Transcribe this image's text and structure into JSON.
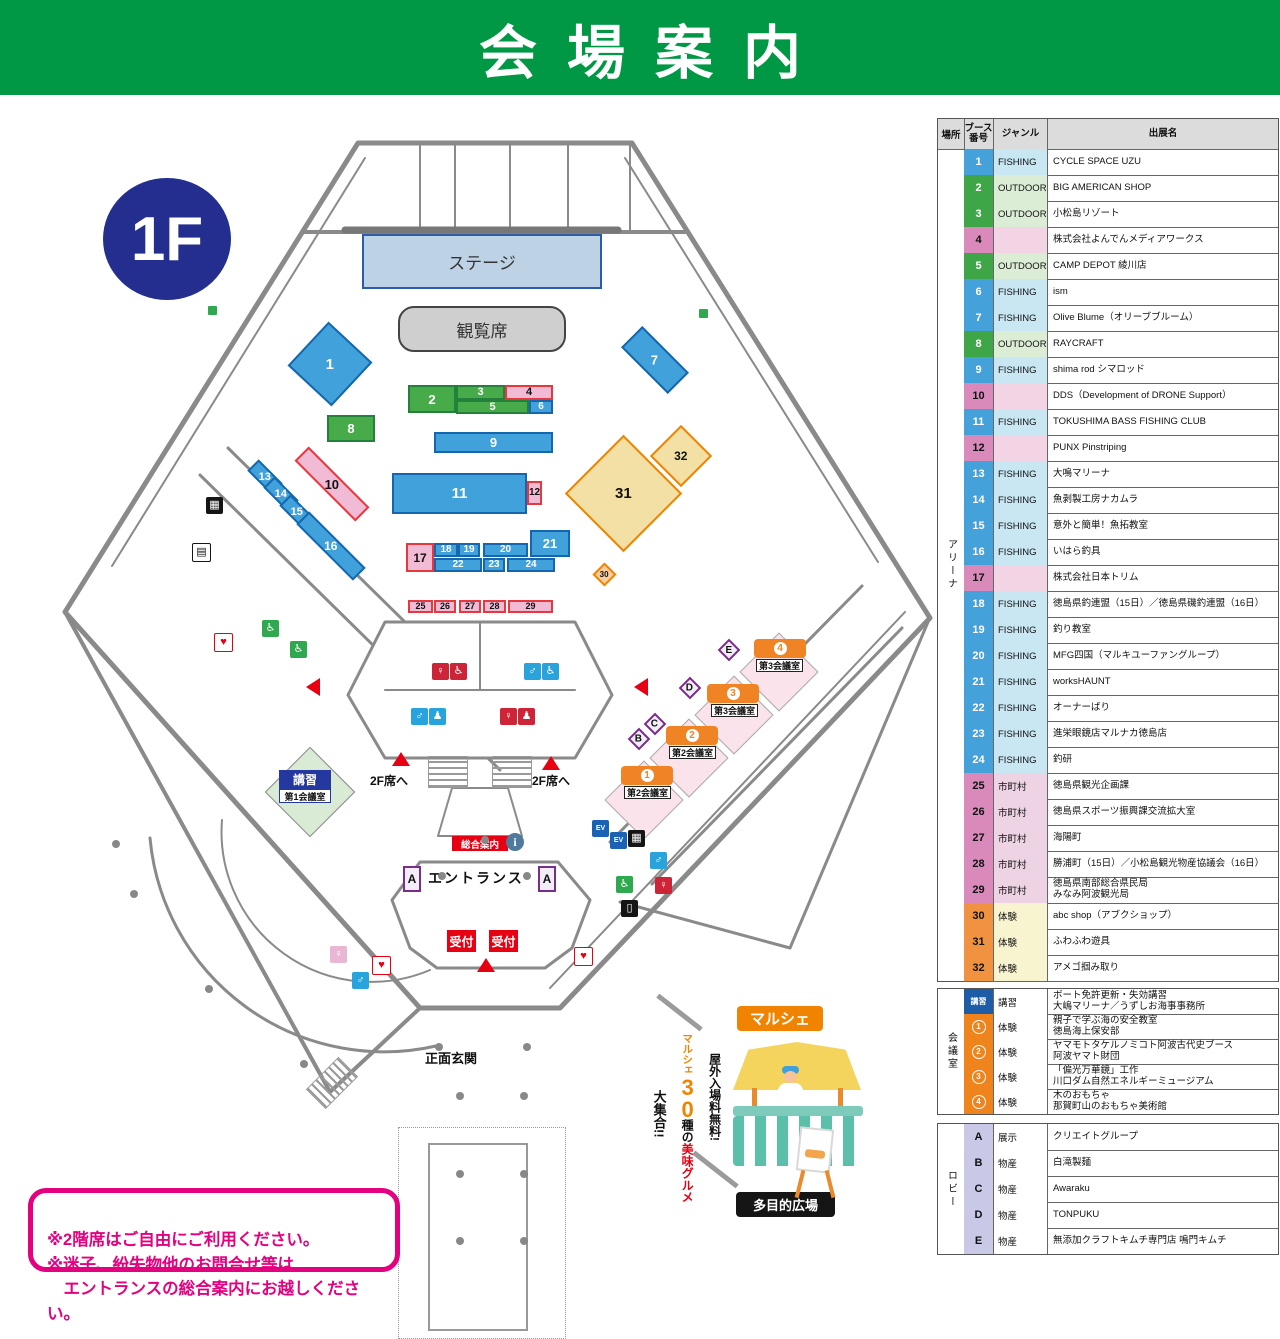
{
  "title": "会場案内",
  "floor_badge": "1F",
  "map": {
    "stage": "ステージ",
    "audience": "観覧席",
    "entrance": "エントランス",
    "main_gate": "正面玄関",
    "to_2f": "2F席へ",
    "info": "総合案内",
    "info_icon": "i",
    "reception": "受付",
    "marche": "マルシェ",
    "multi_plaza": "多目的広場",
    "kosyu_badge": "講習",
    "meeting1": "第1会議室",
    "badge_a": "A",
    "lobby_badges": [
      "B",
      "C",
      "D",
      "E"
    ],
    "meeting_rooms": [
      {
        "num": "1",
        "label": "第2会議室",
        "bx": 621,
        "by": 671,
        "lx": 624,
        "ly": 691
      },
      {
        "num": "2",
        "label": "第2会議室",
        "bx": 666,
        "by": 631,
        "lx": 669,
        "ly": 651
      },
      {
        "num": "3",
        "label": "第3会議室",
        "bx": 707,
        "by": 589,
        "lx": 711,
        "ly": 609
      },
      {
        "num": "4",
        "label": "第3会議室",
        "bx": 754,
        "by": 544,
        "lx": 756,
        "ly": 564
      }
    ],
    "booths": [
      {
        "n": "1",
        "cls": "b-fishing",
        "x": 300,
        "y": 239,
        "w": 60,
        "h": 60,
        "r": 43,
        "fs": 15
      },
      {
        "n": "2",
        "cls": "b-outdoor",
        "x": 408,
        "y": 290,
        "w": 48,
        "h": 28,
        "r": 0,
        "fs": 13
      },
      {
        "n": "3",
        "cls": "b-outdoor",
        "x": 456,
        "y": 290,
        "w": 49,
        "h": 15,
        "r": 0,
        "fs": 11
      },
      {
        "n": "4",
        "cls": "b-pink",
        "x": 505,
        "y": 290,
        "w": 48,
        "h": 15,
        "r": 0,
        "fs": 11
      },
      {
        "n": "5",
        "cls": "b-outdoor",
        "x": 456,
        "y": 305,
        "w": 73,
        "h": 14,
        "r": 0,
        "fs": 11
      },
      {
        "n": "6",
        "cls": "b-fishing",
        "x": 529,
        "y": 305,
        "w": 24,
        "h": 14,
        "r": 0,
        "fs": 10
      },
      {
        "n": "7",
        "cls": "b-fishing",
        "x": 622,
        "y": 250,
        "w": 66,
        "h": 30,
        "r": 45,
        "fs": 13
      },
      {
        "n": "8",
        "cls": "b-outdoor",
        "x": 327,
        "y": 320,
        "w": 48,
        "h": 27,
        "r": 0,
        "fs": 13
      },
      {
        "n": "9",
        "cls": "b-fishing",
        "x": 434,
        "y": 337,
        "w": 119,
        "h": 21,
        "r": 0,
        "fs": 13
      },
      {
        "n": "10",
        "cls": "b-pink",
        "x": 289,
        "y": 379,
        "w": 86,
        "h": 20,
        "r": 45,
        "fs": 13
      },
      {
        "n": "11",
        "cls": "b-fishing",
        "x": 392,
        "y": 378,
        "w": 135,
        "h": 41,
        "r": 0,
        "fs": 15
      },
      {
        "n": "12",
        "cls": "b-pink",
        "x": 527,
        "y": 386,
        "w": 15,
        "h": 24,
        "r": 0,
        "fs": 10
      },
      {
        "n": "13",
        "cls": "b-fishing",
        "x": 248,
        "y": 374,
        "w": 34,
        "h": 16,
        "r": 45,
        "fs": 11
      },
      {
        "n": "14",
        "cls": "b-fishing",
        "x": 264,
        "y": 391,
        "w": 34,
        "h": 16,
        "r": 45,
        "fs": 11
      },
      {
        "n": "15",
        "cls": "b-fishing",
        "x": 280,
        "y": 409,
        "w": 34,
        "h": 16,
        "r": 45,
        "fs": 11
      },
      {
        "n": "16",
        "cls": "b-fishing",
        "x": 291,
        "y": 442,
        "w": 80,
        "h": 18,
        "r": 45,
        "fs": 12
      },
      {
        "n": "17",
        "cls": "b-pink",
        "x": 406,
        "y": 448,
        "w": 28,
        "h": 29,
        "r": 0,
        "fs": 12
      },
      {
        "n": "18",
        "cls": "b-fishing",
        "x": 434,
        "y": 448,
        "w": 24,
        "h": 14,
        "r": 0,
        "fs": 10
      },
      {
        "n": "19",
        "cls": "b-fishing",
        "x": 458,
        "y": 448,
        "w": 22,
        "h": 14,
        "r": 0,
        "fs": 10
      },
      {
        "n": "20",
        "cls": "b-fishing",
        "x": 483,
        "y": 448,
        "w": 45,
        "h": 14,
        "r": 0,
        "fs": 10
      },
      {
        "n": "21",
        "cls": "b-fishing",
        "x": 530,
        "y": 435,
        "w": 40,
        "h": 27,
        "r": 0,
        "fs": 13
      },
      {
        "n": "22",
        "cls": "b-fishing",
        "x": 434,
        "y": 463,
        "w": 48,
        "h": 14,
        "r": 0,
        "fs": 10
      },
      {
        "n": "23",
        "cls": "b-fishing",
        "x": 483,
        "y": 463,
        "w": 22,
        "h": 14,
        "r": 0,
        "fs": 10
      },
      {
        "n": "24",
        "cls": "b-fishing",
        "x": 507,
        "y": 463,
        "w": 48,
        "h": 14,
        "r": 0,
        "fs": 10
      },
      {
        "n": "25",
        "cls": "b-pink",
        "x": 408,
        "y": 505,
        "w": 25,
        "h": 13,
        "r": 0,
        "fs": 9
      },
      {
        "n": "26",
        "cls": "b-pink",
        "x": 434,
        "y": 505,
        "w": 22,
        "h": 13,
        "r": 0,
        "fs": 9
      },
      {
        "n": "27",
        "cls": "b-pink",
        "x": 459,
        "y": 505,
        "w": 22,
        "h": 13,
        "r": 0,
        "fs": 9
      },
      {
        "n": "28",
        "cls": "b-pink",
        "x": 483,
        "y": 505,
        "w": 23,
        "h": 13,
        "r": 0,
        "fs": 9
      },
      {
        "n": "29",
        "cls": "b-pink",
        "x": 508,
        "y": 505,
        "w": 45,
        "h": 13,
        "r": 0,
        "fs": 9
      },
      {
        "n": "30",
        "cls": "b-orangesm",
        "x": 596,
        "y": 471,
        "w": 17,
        "h": 17,
        "r": 45,
        "fs": 8
      },
      {
        "n": "31",
        "cls": "b-yellow",
        "x": 582,
        "y": 357,
        "w": 83,
        "h": 83,
        "r": 45,
        "fs": 15
      },
      {
        "n": "32",
        "cls": "b-yellow",
        "x": 659,
        "y": 339,
        "w": 44,
        "h": 44,
        "r": 45,
        "fs": 12
      }
    ],
    "icons": [
      {
        "name": "womens-toilet-icon",
        "x": 432,
        "y": 568,
        "bg": "#CE2438",
        "fg": "#fff",
        "glyph": "♀"
      },
      {
        "name": "wheelchair-icon",
        "x": 450,
        "y": 568,
        "bg": "#CE2438",
        "fg": "#fff",
        "glyph": "♿"
      },
      {
        "name": "mens-toilet-icon",
        "x": 524,
        "y": 568,
        "bg": "#29A3DC",
        "fg": "#fff",
        "glyph": "♂"
      },
      {
        "name": "wheelchair-icon",
        "x": 542,
        "y": 568,
        "bg": "#29A3DC",
        "fg": "#fff",
        "glyph": "♿"
      },
      {
        "name": "mens-toilet-icon",
        "x": 411,
        "y": 613,
        "bg": "#29A3DC",
        "fg": "#fff",
        "glyph": "♂"
      },
      {
        "name": "baby-change-icon",
        "x": 429,
        "y": 613,
        "bg": "#29A3DC",
        "fg": "#fff",
        "glyph": "♟"
      },
      {
        "name": "womens-toilet-icon",
        "x": 500,
        "y": 613,
        "bg": "#CE2438",
        "fg": "#fff",
        "glyph": "♀"
      },
      {
        "name": "baby-change-icon",
        "x": 518,
        "y": 613,
        "bg": "#CE2438",
        "fg": "#fff",
        "glyph": "♟"
      },
      {
        "name": "wheelchair-icon",
        "x": 262,
        "y": 525,
        "bg": "#2FA84F",
        "fg": "#fff",
        "glyph": "♿"
      },
      {
        "name": "wheelchair-icon",
        "x": 290,
        "y": 546,
        "bg": "#2FA84F",
        "fg": "#fff",
        "glyph": "♿"
      },
      {
        "name": "aed-icon",
        "x": 214,
        "y": 538,
        "bg": "#fff",
        "fg": "#E60012",
        "glyph": "♥",
        "bd": "#E60012"
      },
      {
        "name": "locker-icon",
        "x": 206,
        "y": 402,
        "bg": "#151515",
        "fg": "#fff",
        "glyph": "▦"
      },
      {
        "name": "coin-locker-icon",
        "x": 192,
        "y": 448,
        "bg": "#fff",
        "fg": "#151515",
        "glyph": "▤",
        "bd": "#151515"
      },
      {
        "name": "elevator-icon",
        "x": 592,
        "y": 725,
        "bg": "#1B62B5",
        "fg": "#fff",
        "glyph": "EV"
      },
      {
        "name": "elevator-icon",
        "x": 610,
        "y": 737,
        "bg": "#1B62B5",
        "fg": "#fff",
        "glyph": "EV"
      },
      {
        "name": "vending-icon",
        "x": 628,
        "y": 735,
        "bg": "#151515",
        "fg": "#fff",
        "glyph": "▦"
      },
      {
        "name": "mens-toilet-icon",
        "x": 650,
        "y": 757,
        "bg": "#29A3DC",
        "fg": "#fff",
        "glyph": "♂"
      },
      {
        "name": "wheelchair-icon",
        "x": 616,
        "y": 781,
        "bg": "#2FA84F",
        "fg": "#fff",
        "glyph": "♿"
      },
      {
        "name": "womens-toilet-icon",
        "x": 655,
        "y": 782,
        "bg": "#CE2438",
        "fg": "#fff",
        "glyph": "♀"
      },
      {
        "name": "trash-icon",
        "x": 621,
        "y": 805,
        "bg": "#151515",
        "fg": "#fff",
        "glyph": "▯"
      },
      {
        "name": "aed-icon",
        "x": 574,
        "y": 852,
        "bg": "#fff",
        "fg": "#E60012",
        "glyph": "♥",
        "bd": "#E60012"
      },
      {
        "name": "aed-icon",
        "x": 372,
        "y": 861,
        "bg": "#fff",
        "fg": "#E60012",
        "glyph": "♥",
        "bd": "#E60012"
      },
      {
        "name": "womens-toilet-icon",
        "x": 330,
        "y": 851,
        "bg": "#E9B7D3",
        "fg": "#fff",
        "glyph": "♀"
      },
      {
        "name": "mens-toilet-icon",
        "x": 352,
        "y": 877,
        "bg": "#29A3DC",
        "fg": "#fff",
        "glyph": "♂"
      }
    ],
    "arrows": [
      {
        "x": 392,
        "y": 657,
        "dir": "up"
      },
      {
        "x": 542,
        "y": 661,
        "dir": "up"
      },
      {
        "x": 477,
        "y": 863,
        "dir": "up"
      },
      {
        "x": 306,
        "y": 583,
        "dir": "left"
      },
      {
        "x": 634,
        "y": 583,
        "dir": "left"
      }
    ]
  },
  "promo": {
    "line_free": "屋外入場料無料!",
    "word_marche": "マルシェ",
    "num": "30",
    "word_kind": "種の",
    "word_gourmet": "美味グルメ",
    "word_gather": "大集合!!"
  },
  "notice": "※2階席はご自由にご利用ください。\n※迷子、紛失物他のお問合せ等は\n　エントランスの総合案内にお越しください。",
  "table": {
    "headers": [
      "場所",
      "ブース\n番号",
      "ジャンル",
      "出展名"
    ],
    "sections": [
      {
        "place": "アリーナ",
        "rows": [
          {
            "no": "1",
            "ncls": "n-fishing",
            "genre": "FISHING",
            "gcls": "g-fishing",
            "name": "CYCLE SPACE UZU"
          },
          {
            "no": "2",
            "ncls": "n-outdoor",
            "genre": "OUTDOOR",
            "gcls": "g-outdoor",
            "name": "BIG AMERICAN SHOP"
          },
          {
            "no": "3",
            "ncls": "n-outdoor",
            "genre": "OUTDOOR",
            "gcls": "g-outdoor",
            "name": "小松島リゾート"
          },
          {
            "no": "4",
            "ncls": "n-pink",
            "genre": "",
            "gcls": "g-pink",
            "name": "株式会社よんでんメディアワークス"
          },
          {
            "no": "5",
            "ncls": "n-outdoor",
            "genre": "OUTDOOR",
            "gcls": "g-outdoor",
            "name": "CAMP DEPOT 綾川店"
          },
          {
            "no": "6",
            "ncls": "n-fishing",
            "genre": "FISHING",
            "gcls": "g-fishing",
            "name": "ism"
          },
          {
            "no": "7",
            "ncls": "n-fishing",
            "genre": "FISHING",
            "gcls": "g-fishing",
            "name": "Olive Blume（オリーブブルーム）"
          },
          {
            "no": "8",
            "ncls": "n-outdoor",
            "genre": "OUTDOOR",
            "gcls": "g-outdoor",
            "name": "RAYCRAFT"
          },
          {
            "no": "9",
            "ncls": "n-fishing",
            "genre": "FISHING",
            "gcls": "g-fishing",
            "name": "shima rod シマロッド"
          },
          {
            "no": "10",
            "ncls": "n-pink",
            "genre": "",
            "gcls": "g-pink",
            "name": "DDS（Development of DRONE Support）"
          },
          {
            "no": "11",
            "ncls": "n-fishing",
            "genre": "FISHING",
            "gcls": "g-fishing",
            "name": "TOKUSHIMA BASS FISHING CLUB"
          },
          {
            "no": "12",
            "ncls": "n-pink",
            "genre": "",
            "gcls": "g-pink",
            "name": "PUNX Pinstriping"
          },
          {
            "no": "13",
            "ncls": "n-fishing",
            "genre": "FISHING",
            "gcls": "g-fishing",
            "name": "大鳴マリーナ"
          },
          {
            "no": "14",
            "ncls": "n-fishing",
            "genre": "FISHING",
            "gcls": "g-fishing",
            "name": "魚剥製工房ナカムラ"
          },
          {
            "no": "15",
            "ncls": "n-fishing",
            "genre": "FISHING",
            "gcls": "g-fishing",
            "name": "意外と簡単！魚拓教室"
          },
          {
            "no": "16",
            "ncls": "n-fishing",
            "genre": "FISHING",
            "gcls": "g-fishing",
            "name": "いはら釣具"
          },
          {
            "no": "17",
            "ncls": "n-pink",
            "genre": "",
            "gcls": "g-pink",
            "name": "株式会社日本トリム"
          },
          {
            "no": "18",
            "ncls": "n-fishing",
            "genre": "FISHING",
            "gcls": "g-fishing",
            "name": "徳島県釣連盟（15日）／徳島県磯釣連盟（16日）"
          },
          {
            "no": "19",
            "ncls": "n-fishing",
            "genre": "FISHING",
            "gcls": "g-fishing",
            "name": "釣り教室"
          },
          {
            "no": "20",
            "ncls": "n-fishing",
            "genre": "FISHING",
            "gcls": "g-fishing",
            "name": "MFG四国（マルキユーファングループ）"
          },
          {
            "no": "21",
            "ncls": "n-fishing",
            "genre": "FISHING",
            "gcls": "g-fishing",
            "name": "worksHAUNT"
          },
          {
            "no": "22",
            "ncls": "n-fishing",
            "genre": "FISHING",
            "gcls": "g-fishing",
            "name": "オーナーばり"
          },
          {
            "no": "23",
            "ncls": "n-fishing",
            "genre": "FISHING",
            "gcls": "g-fishing",
            "name": "進栄眼鏡店マルナカ徳島店"
          },
          {
            "no": "24",
            "ncls": "n-fishing",
            "genre": "FISHING",
            "gcls": "g-fishing",
            "name": "釣研"
          },
          {
            "no": "25",
            "ncls": "n-pink",
            "genre": "市町村",
            "gcls": "g-muni",
            "name": "徳島県観光企画課"
          },
          {
            "no": "26",
            "ncls": "n-pink",
            "genre": "市町村",
            "gcls": "g-muni",
            "name": "徳島県スポーツ振興課交流拡大室"
          },
          {
            "no": "27",
            "ncls": "n-pink",
            "genre": "市町村",
            "gcls": "g-muni",
            "name": "海陽町"
          },
          {
            "no": "28",
            "ncls": "n-pink",
            "genre": "市町村",
            "gcls": "g-muni",
            "name": "勝浦町（15日）／小松島観光物産協議会（16日）"
          },
          {
            "no": "29",
            "ncls": "n-pink",
            "genre": "市町村",
            "gcls": "g-muni",
            "name": "徳島県南部総合県民局\nみなみ阿波観光局"
          },
          {
            "no": "30",
            "ncls": "n-orange",
            "genre": "体験",
            "gcls": "g-taiken",
            "name": "abc shop（アブクショップ）"
          },
          {
            "no": "31",
            "ncls": "n-orange",
            "genre": "体験",
            "gcls": "g-taiken",
            "name": "ふわふわ遊具"
          },
          {
            "no": "32",
            "ncls": "n-orange",
            "genre": "体験",
            "gcls": "g-taiken",
            "name": "アメゴ掴み取り"
          }
        ]
      },
      {
        "place": "会議室",
        "rows": [
          {
            "no": "講習",
            "ncls": "n-kosyu",
            "genre": "講習",
            "gcls": "g-plain",
            "name": "ボート免許更新・失効講習\n大嶋マリーナ／うずしお海事事務所"
          },
          {
            "no": "1",
            "ring": true,
            "ncls": "n-circ",
            "genre": "体験",
            "gcls": "g-plain",
            "name": "親子で学ぶ海の安全教室\n徳島海上保安部"
          },
          {
            "no": "2",
            "ring": true,
            "ncls": "n-circ",
            "genre": "体験",
            "gcls": "g-plain",
            "name": "ヤマモトタケルノミコト阿波古代史ブース\n阿波ヤマト財団"
          },
          {
            "no": "3",
            "ring": true,
            "ncls": "n-circ",
            "genre": "体験",
            "gcls": "g-plain",
            "name": "「偏光万華鏡」工作\n川口ダム自然エネルギーミュージアム"
          },
          {
            "no": "4",
            "ring": true,
            "ncls": "n-circ",
            "genre": "体験",
            "gcls": "g-plain",
            "name": "木のおもちゃ\n那賀町山のおもちゃ美術館"
          }
        ]
      },
      {
        "place": "ロビー",
        "rows": [
          {
            "no": "A",
            "ncls": "n-lobby",
            "genre": "展示",
            "gcls": "g-plain",
            "name": "クリエイトグループ"
          },
          {
            "no": "B",
            "ncls": "n-lobby",
            "genre": "物産",
            "gcls": "g-plain",
            "name": "白滝製麺"
          },
          {
            "no": "C",
            "ncls": "n-lobby",
            "genre": "物産",
            "gcls": "g-plain",
            "name": "Awaraku"
          },
          {
            "no": "D",
            "ncls": "n-lobby",
            "genre": "物産",
            "gcls": "g-plain",
            "name": "TONPUKU"
          },
          {
            "no": "E",
            "ncls": "n-lobby",
            "genre": "物産",
            "gcls": "g-plain",
            "name": "無添加クラフトキムチ専門店 鳴門キムチ"
          }
        ]
      }
    ]
  }
}
